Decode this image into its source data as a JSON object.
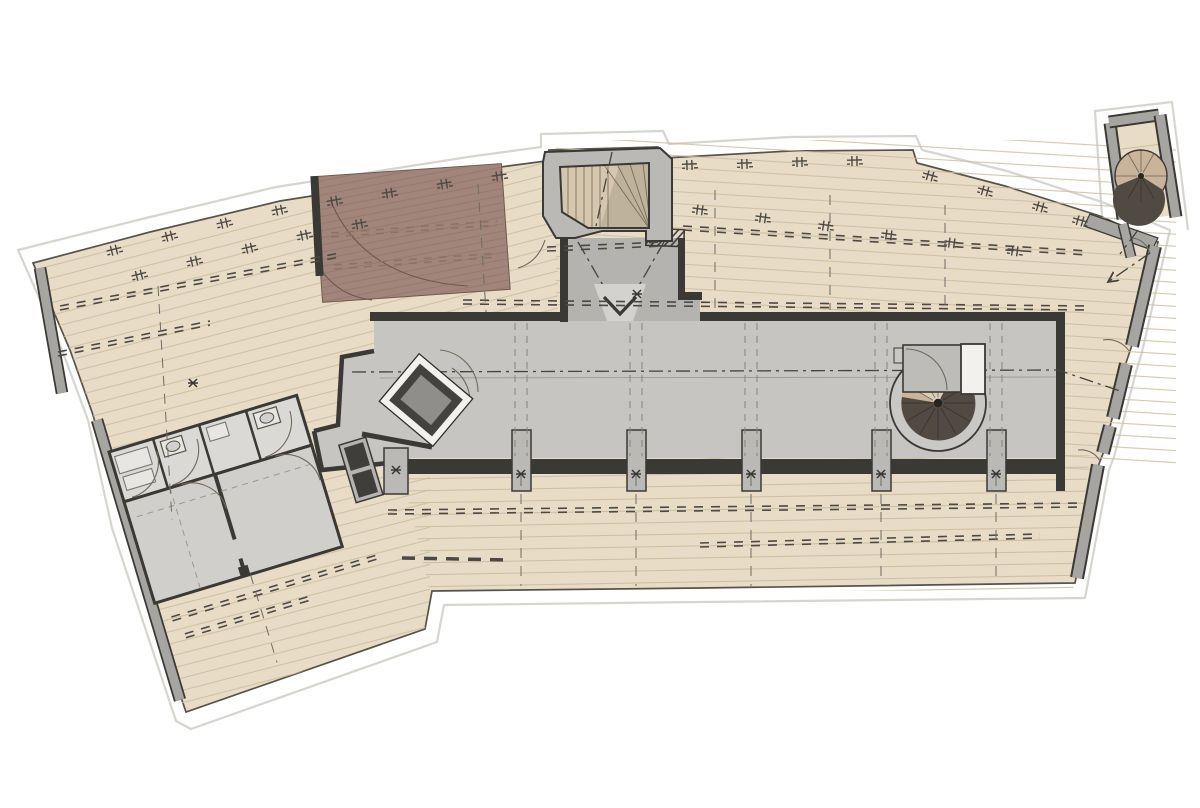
{
  "colors": {
    "page_bg": "#ffffff",
    "site_line": "#d7d5d0",
    "wood": "#e8dcc6",
    "wood_line": "#cbbc9f",
    "wood_edge": "#57534b",
    "wall_dark": "#3b3936",
    "wall_gray": "#a6a5a1",
    "wall_light": "#bab9b5",
    "corridor": "#c6c5c2",
    "vestibule": "#b4b3af",
    "room_gray": "#d1d0cd",
    "fixture": "#e7e6e3",
    "patch": "#a1857a",
    "patch_line": "#8d7164",
    "stair_tread": "#d5c7ae",
    "spiral_dark": "#514a43",
    "spiral_tan": "#c9b39a",
    "dash": "#4c4843",
    "marker": "#3a3834",
    "white_fixture": "#f2f1ee"
  }
}
